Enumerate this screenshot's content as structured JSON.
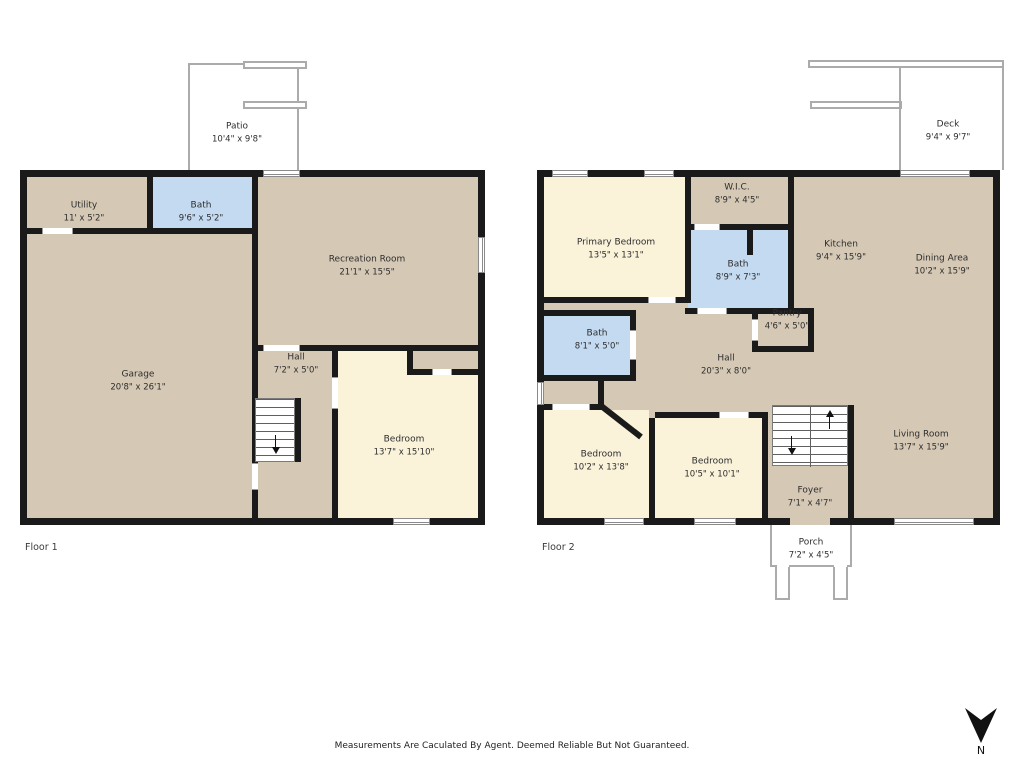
{
  "footer": {
    "disclaimer": "Measurements Are Caculated By Agent. Deemed Reliable But Not Guaranteed."
  },
  "compass": {
    "label": "N"
  },
  "palette": {
    "wall": "#1a1a1a",
    "room_tan": "#d5c8b5",
    "room_cream": "#faf3da",
    "room_blue": "#c4daf1",
    "outdoor_outline": "#ababab"
  },
  "floors": [
    {
      "label": "Floor 1",
      "rooms": {
        "patio": {
          "name": "Patio",
          "dims": "10'4\" x 9'8\""
        },
        "utility": {
          "name": "Utility",
          "dims": "11' x 5'2\""
        },
        "bath": {
          "name": "Bath",
          "dims": "9'6\" x 5'2\""
        },
        "recreation": {
          "name": "Recreation Room",
          "dims": "21'1\" x 15'5\""
        },
        "garage": {
          "name": "Garage",
          "dims": "20'8\" x 26'1\""
        },
        "hall": {
          "name": "Hall",
          "dims": "7'2\" x 5'0\""
        },
        "bedroom": {
          "name": "Bedroom",
          "dims": "13'7\" x 15'10\""
        }
      }
    },
    {
      "label": "Floor 2",
      "rooms": {
        "deck": {
          "name": "Deck",
          "dims": "9'4\" x 9'7\""
        },
        "primary_bedroom": {
          "name": "Primary Bedroom",
          "dims": "13'5\" x 13'1\""
        },
        "wic": {
          "name": "W.I.C.",
          "dims": "8'9\" x 4'5\""
        },
        "bath": {
          "name": "Bath",
          "dims": "8'9\" x 7'3\""
        },
        "kitchen": {
          "name": "Kitchen",
          "dims": "9'4\" x 15'9\""
        },
        "dining": {
          "name": "Dining Area",
          "dims": "10'2\" x 15'9\""
        },
        "pantry": {
          "name": "Pantry",
          "dims": "4'6\" x 5'0\""
        },
        "bath2": {
          "name": "Bath",
          "dims": "8'1\" x 5'0\""
        },
        "hall": {
          "name": "Hall",
          "dims": "20'3\" x 8'0\""
        },
        "bedroom_a": {
          "name": "Bedroom",
          "dims": "10'2\" x 13'8\""
        },
        "bedroom_b": {
          "name": "Bedroom",
          "dims": "10'5\" x 10'1\""
        },
        "foyer": {
          "name": "Foyer",
          "dims": "7'1\" x 4'7\""
        },
        "living": {
          "name": "Living Room",
          "dims": "13'7\" x 15'9\""
        },
        "porch": {
          "name": "Porch",
          "dims": "7'2\" x 4'5\""
        }
      }
    }
  ]
}
